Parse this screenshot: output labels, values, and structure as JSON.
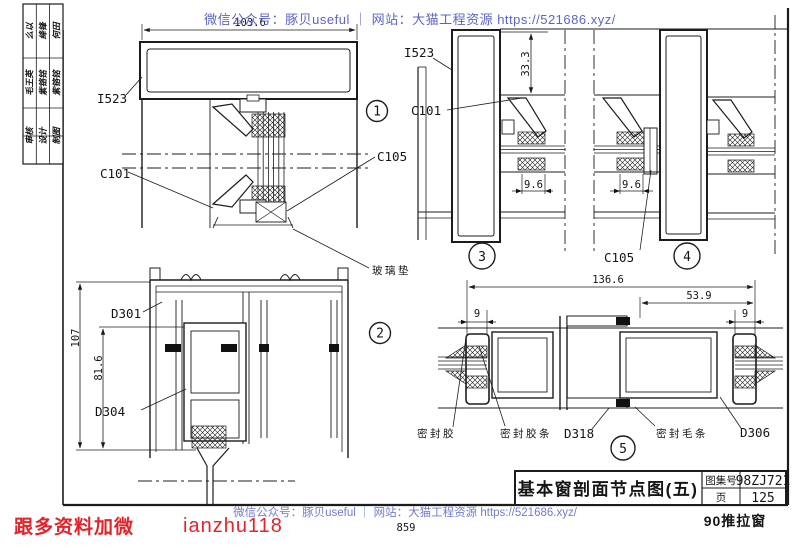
{
  "watermark": {
    "top_text": "微信公众号：豚贝useful ｜ 网站：大猫工程资源 https://521686.xyz/",
    "bottom_text": "微信公众号：豚贝useful ｜ 网站：大猫工程资源 https://521686.xyz/",
    "color": "#5a64c8"
  },
  "promo": {
    "prefix": "跟多资料加微",
    "handle": "ianzhu118",
    "color": "#e2242a"
  },
  "footer": {
    "sheet_number": "859",
    "caption": "90推拉窗"
  },
  "title_block": {
    "title": "基本窗剖面节点图(五)",
    "atlas_label": "图集号",
    "atlas_number": "98ZJ721",
    "page_label": "页",
    "page_number": "125"
  },
  "sidebar": {
    "top_cells": [
      "么以",
      "绛锋",
      "何田"
    ],
    "mid_cells": [
      "毛王英",
      "紫铬铭",
      "紫铬铭"
    ],
    "bottom_cells": [
      "审核",
      "设计",
      "制图"
    ]
  },
  "details": {
    "one": {
      "num": "1",
      "dim_width": "103.6",
      "label_i523": "I523",
      "label_c101": "C101",
      "label_c105": "C105",
      "label_glass_pad": "玻璃垫"
    },
    "two": {
      "num": "2",
      "dim_h_outer": "107",
      "dim_h_inner": "81.6",
      "label_d301": "D301",
      "label_d304": "D304"
    },
    "three": {
      "num": "3",
      "label_i523": "I523",
      "label_c101": "C101",
      "dim_top": "33.3",
      "dim_w": "9.6"
    },
    "four": {
      "num": "4",
      "label_c105": "C105",
      "dim_w": "9.6"
    },
    "five": {
      "num": "5",
      "dim_total": "136.6",
      "dim_half": "53.9",
      "dim_left": "9",
      "dim_right": "9",
      "label_sealant": "密封胶",
      "label_gasket": "密封胶条",
      "label_d318": "D318",
      "label_wool": "密封毛条",
      "label_d306": "D306"
    }
  }
}
